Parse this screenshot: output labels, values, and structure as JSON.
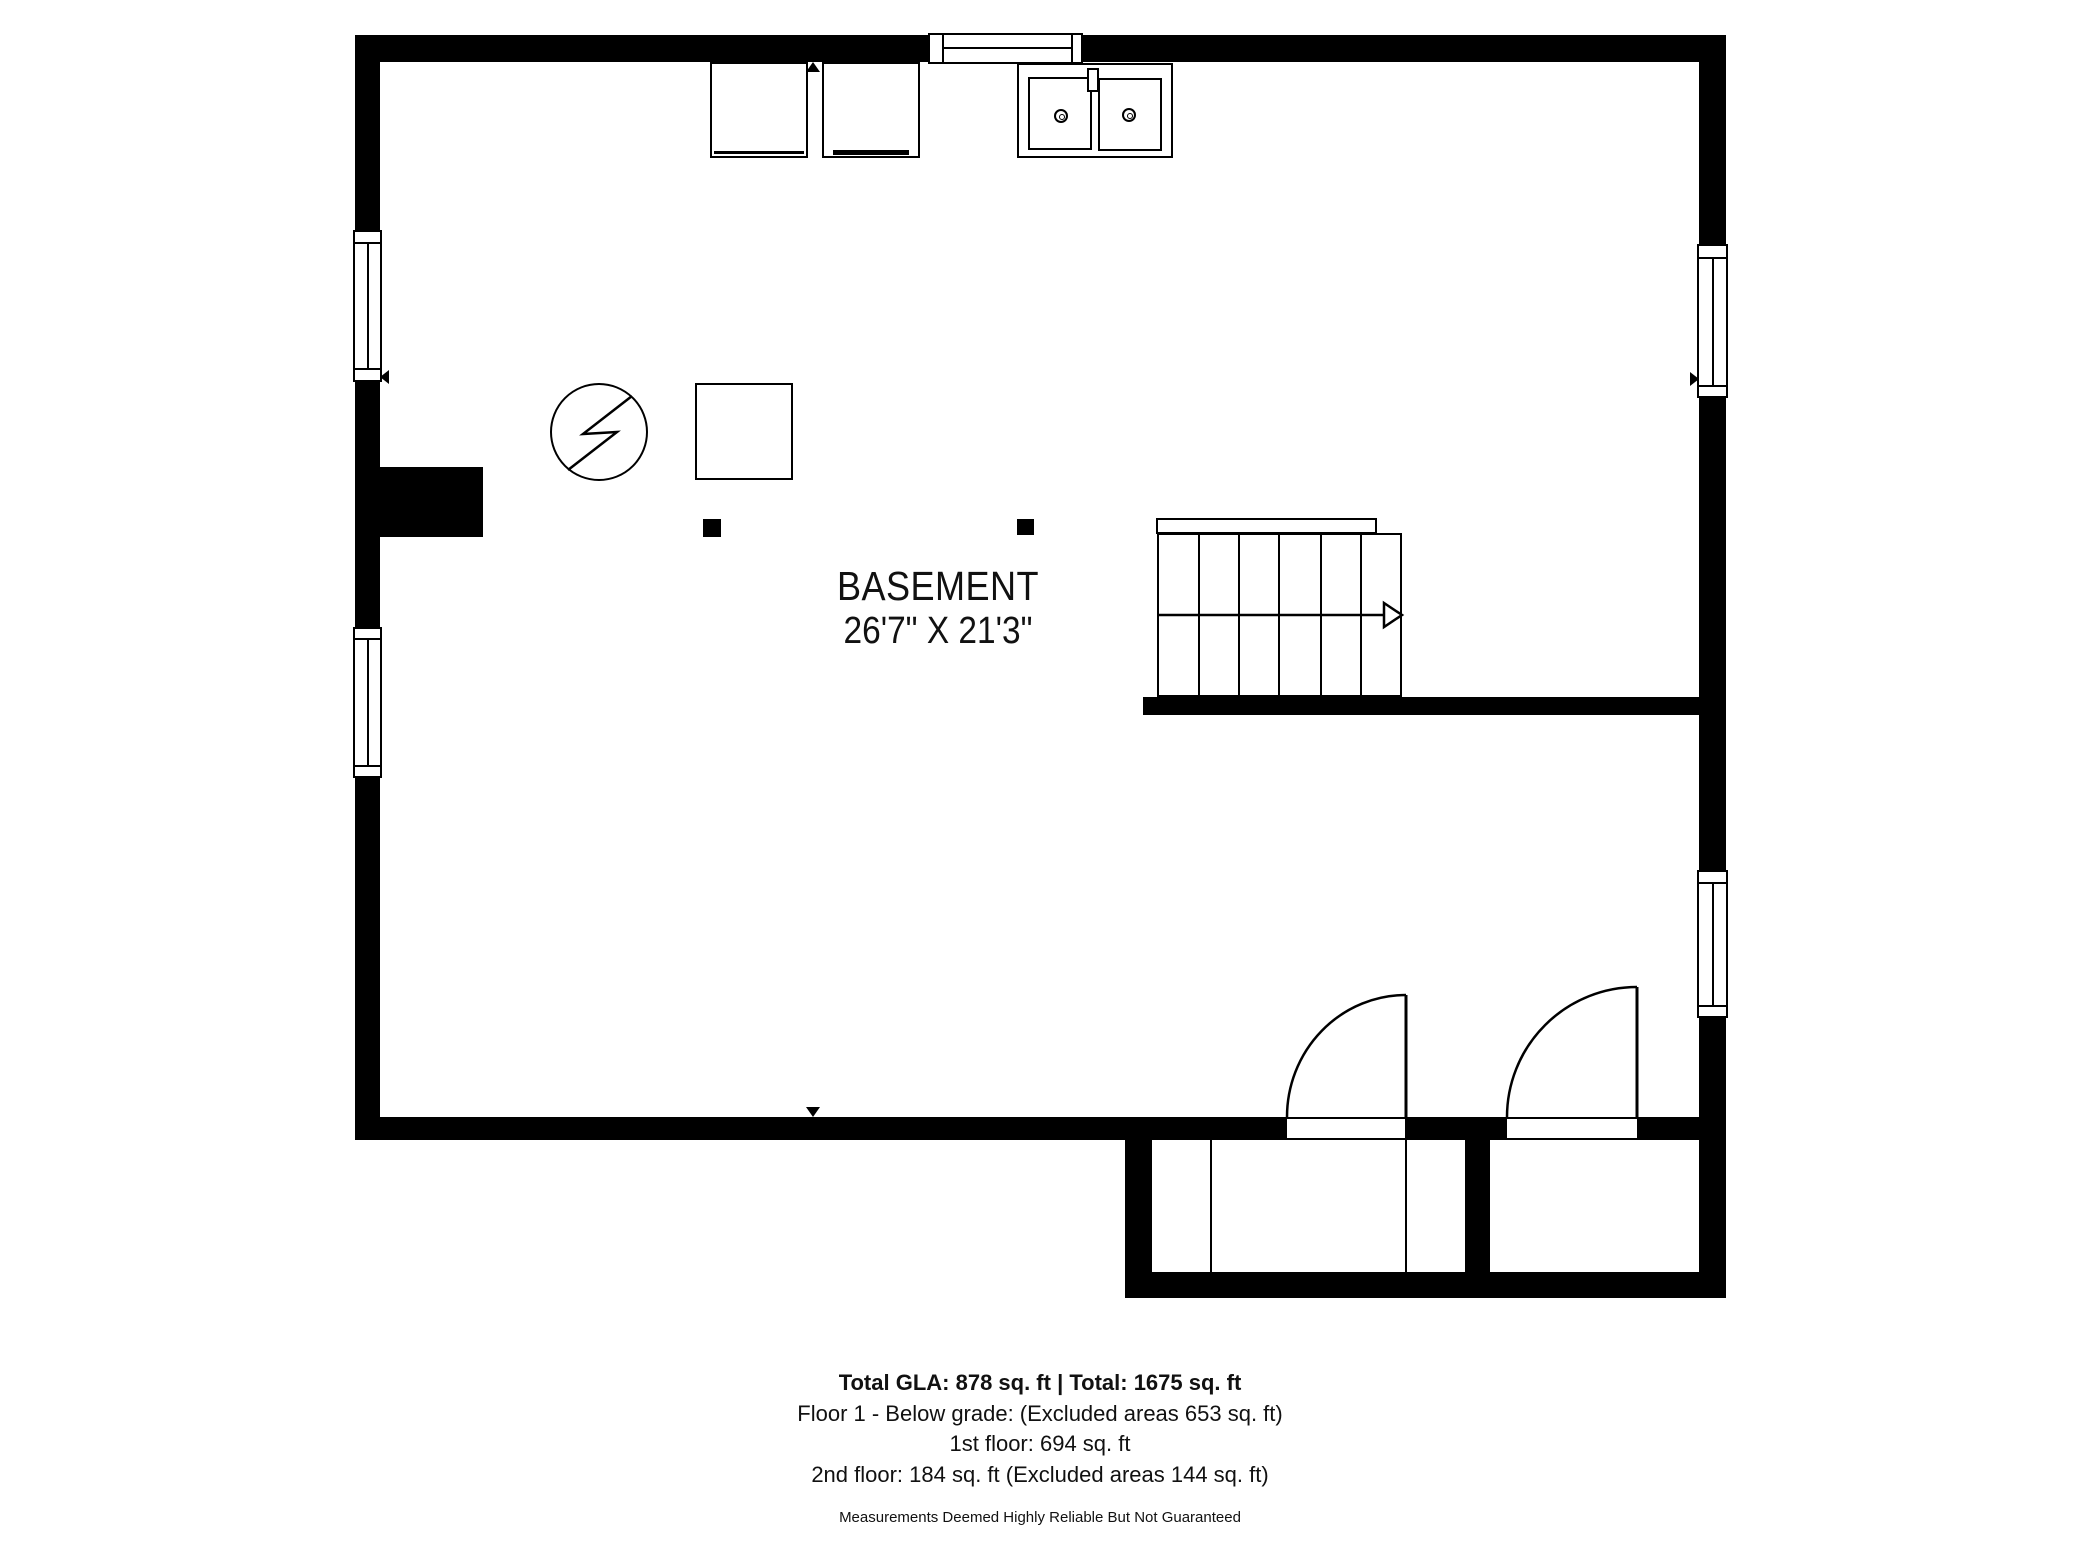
{
  "room": {
    "name": "BASEMENT",
    "dimensions": "26'7\" X 21'3\""
  },
  "summary": {
    "total_line": "Total GLA: 878 sq. ft | Total: 1675 sq. ft",
    "floor1_line": "Floor 1 - Below grade: (Excluded areas 653 sq. ft)",
    "first_floor_line": "1st floor: 694 sq. ft",
    "second_floor_line": "2nd floor: 184 sq. ft (Excluded areas 144 sq. ft)",
    "disclaimer": "Measurements Deemed Highly Reliable But Not Guaranteed"
  },
  "colors": {
    "wall": "#000000",
    "background": "#ffffff",
    "text": "#111111"
  },
  "symbols": {
    "stairs": "stairs-up",
    "water_heater": "water-heater-symbol",
    "furnace": "furnace-square",
    "sink": "double-basin-sink",
    "appliances": "washer-dryer"
  }
}
